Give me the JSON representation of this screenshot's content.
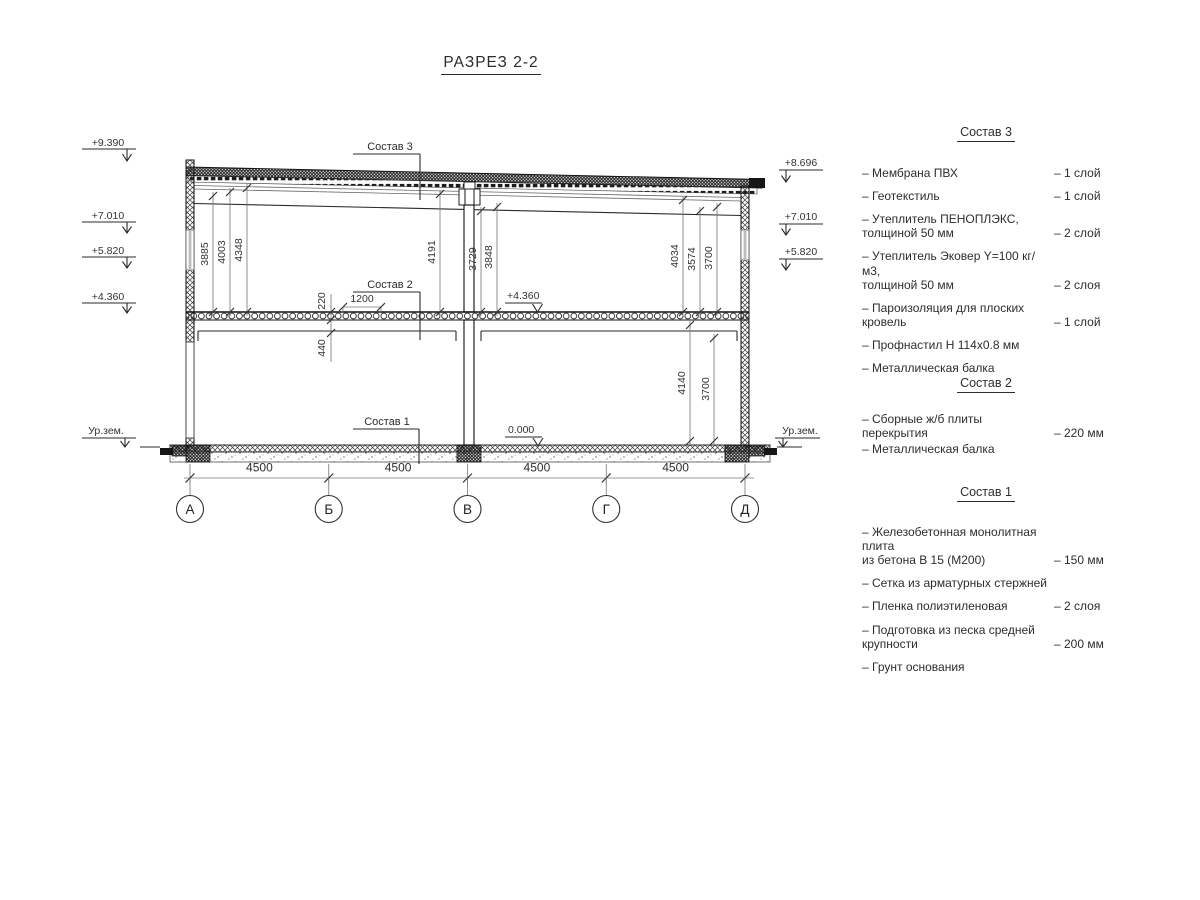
{
  "title": "РАЗРЕЗ 2-2",
  "section": {
    "elev_left": [
      "+9.390",
      "+7.010",
      "+5.820",
      "+4.360"
    ],
    "elev_right": [
      "+8.696",
      "+7.010",
      "+5.820"
    ],
    "ground_left": "Ур.зем.",
    "ground_right": "Ур.зем.",
    "dims_upper": [
      "3885",
      "4003",
      "4348",
      "4191",
      "3729",
      "3848",
      "4034",
      "3574",
      "3700"
    ],
    "dims_lower": [
      "4140",
      "3700"
    ],
    "dim_slab_thickness": "220",
    "dim_beam_height": "440",
    "dim_opening": "1200",
    "mark_mid_floor": "+4.360",
    "mark_zero": "0.000",
    "leader_3": "Состав 3",
    "leader_2": "Состав 2",
    "leader_1": "Состав 1",
    "span_dims": [
      "4500",
      "4500",
      "4500",
      "4500"
    ],
    "axes": [
      "А",
      "Б",
      "В",
      "Г",
      "Д"
    ]
  },
  "legend": {
    "s3": {
      "title": "Состав 3",
      "items": [
        {
          "name": "– Мембрана ПВХ",
          "value": "– 1 слой"
        },
        {
          "name": "– Геотекстиль",
          "value": "– 1 слой"
        },
        {
          "name": "– Утеплитель ПЕНОПЛЭКС,\nтолщиной 50 мм",
          "value": "– 2 слой"
        },
        {
          "name": "– Утеплитель Эковер Y=100 кг/м3,\nтолщиной 50 мм",
          "value": "– 2 слоя"
        },
        {
          "name": "– Пароизоляция для плоских кровель",
          "value": "– 1 слой"
        },
        {
          "name": "– Профнастил Н 114х0.8 мм",
          "value": ""
        },
        {
          "name": "– Металлическая балка",
          "value": ""
        }
      ]
    },
    "s2": {
      "title": "Состав 2",
      "items": [
        {
          "name": "– Сборные ж/б плиты перекрытия",
          "value": "– 220 мм"
        },
        {
          "name": "– Металлическая балка",
          "value": ""
        }
      ]
    },
    "s1": {
      "title": "Состав 1",
      "items": [
        {
          "name": "– Железобетонная  монолитная плита\nиз бетона В 15 (М200)",
          "value": "– 150 мм"
        },
        {
          "name": "– Сетка из арматурных стержней",
          "value": ""
        },
        {
          "name": "– Пленка полиэтиленовая",
          "value": "– 2 слоя"
        },
        {
          "name": "– Подготовка из песка средней\nкрупности",
          "value": "– 200 мм"
        },
        {
          "name": "– Грунт основания",
          "value": ""
        }
      ]
    }
  }
}
